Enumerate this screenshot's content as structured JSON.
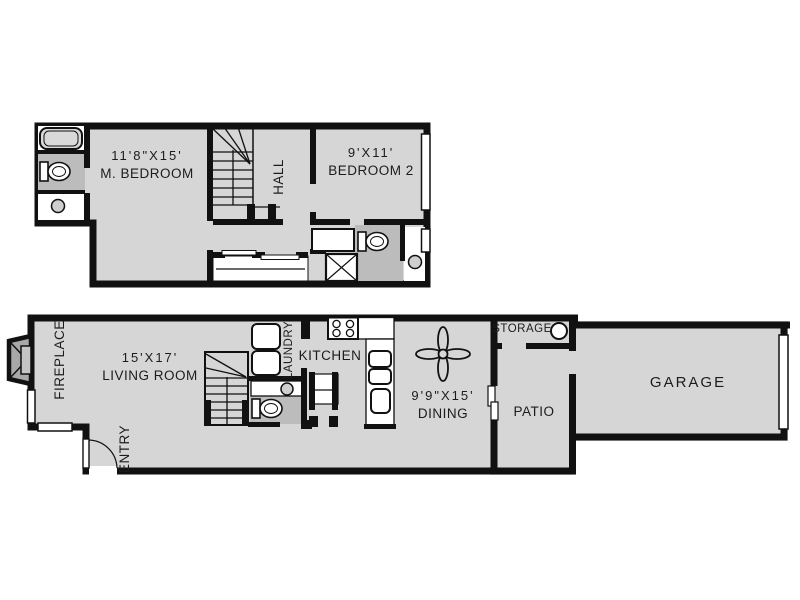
{
  "plan": {
    "type": "two-story townhome floor plan",
    "colors": {
      "floor": "#d6d6d6",
      "wall": "#111111",
      "wet_area": "#bcbcbc",
      "fireplace_fill": "#a8a8a8",
      "fixture": "#ffffff",
      "background": "#ffffff"
    },
    "upper_floor": {
      "master_bedroom": {
        "dimensions": "11'8\"X15'",
        "label": "M. BEDROOM"
      },
      "hall": {
        "label": "HALL"
      },
      "bedroom_2": {
        "dimensions": "9'X11'",
        "label": "BEDROOM 2"
      },
      "fixtures": [
        "bathtub",
        "toilet",
        "sink",
        "stairs",
        "closet-sliding-doors",
        "vanity",
        "shower",
        "toilet-2",
        "sink-2",
        "windows"
      ]
    },
    "lower_floor": {
      "living_room": {
        "dimensions": "15'X17'",
        "label": "LIVING ROOM"
      },
      "fireplace": {
        "label": "FIREPLACE"
      },
      "entry": {
        "label": "ENTRY"
      },
      "laundry": {
        "label": "LAUNDRY"
      },
      "kitchen": {
        "label": "KITCHEN"
      },
      "dining": {
        "dimensions": "9'9\"X15'",
        "label": "DINING"
      },
      "storage": {
        "label": "STORAGE"
      },
      "patio": {
        "label": "PATIO"
      },
      "garage": {
        "label": "GARAGE"
      },
      "fixtures": [
        "fireplace-bay",
        "entry-door",
        "stairs",
        "washer-dryer",
        "half-bath-toilet",
        "half-bath-sink",
        "dinette-table",
        "range",
        "refrigerator",
        "kitchen-sink",
        "ceiling-fan",
        "water-heater",
        "patio-slider",
        "garage-door",
        "windows"
      ]
    }
  }
}
